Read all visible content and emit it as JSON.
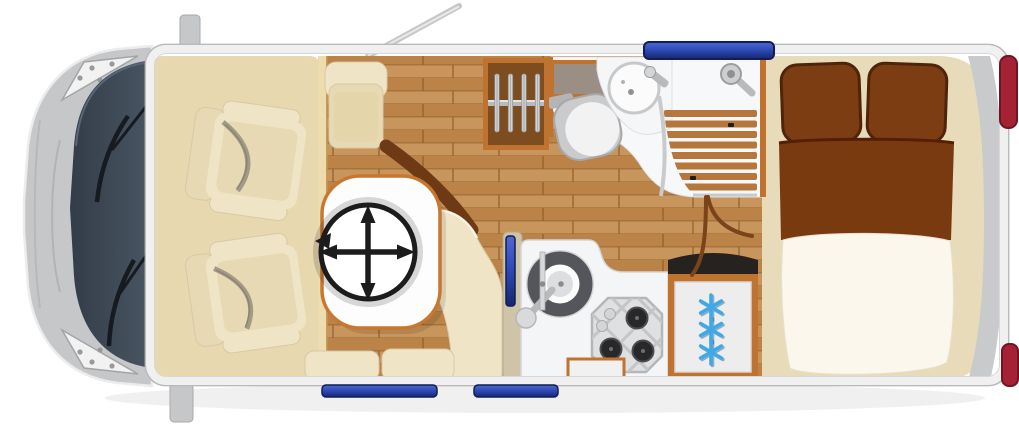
{
  "scene": {
    "kind": "motorhome-floorplan-top-view",
    "icons": {
      "table": "move-arrows-icon",
      "fridge": "snowflake-icon",
      "wardrobe": "hanger-icon",
      "vehicle": "antenna-icon"
    }
  },
  "counts": {
    "hangers": 4,
    "snowflakes": 3,
    "shower_slats": 8,
    "hob_burners": 3,
    "cab_seats": 2,
    "bench_cushions": 2,
    "pillows": 2,
    "bottom_windows": 2,
    "taillights": 2,
    "wipers": 2
  },
  "colors": {
    "body-gray": "#c6c7c9",
    "body-edge": "#ececed",
    "body-line": "#a8a9ab",
    "rim": "#f0f0f1",
    "rim-edge": "#b9babc",
    "windshield-a": "#333d49",
    "windshield-b": "#4a5563",
    "wiper": "#161b21",
    "mat": "#e7d8af",
    "wall-strip": "#ecdcae",
    "wood-a": "#c8955c",
    "wood-b": "#bb8347",
    "wood-seam": "#8f5f2b",
    "wall-orange": "#c0722f",
    "wardrobe-dark": "#7d4d20",
    "cream": "#efe5c6",
    "cream-dark": "#e6d9b3",
    "cream-line": "#d9c9a4",
    "cream-hi": "#f8f3e3",
    "pure-white": "#fdfdfe",
    "table-border": "#c8772f",
    "ink": "#1c1c1c",
    "counter": "#f4f5f7",
    "counter-line": "#d4d5d7",
    "steel": "#b9babc",
    "steel-dark": "#8f9193",
    "sink-ring": "#55565b",
    "hob-face": "#dfe0e2",
    "burner": "#28282a",
    "fridge-face": "#ededee",
    "fridge-top": "#262220",
    "snow": "#3fa9e8",
    "glass-blue": "#2e4cb8",
    "glass-dark": "#17266f",
    "glass-edge": "#101d56",
    "tail-red": "#a52134",
    "tail-dark": "#701522",
    "pillow": "#7d3d12",
    "blanket": "#7a3a10",
    "blanket-edge": "#531f05",
    "duvet": "#fbf7ed",
    "bath-white": "#f7f8f9",
    "slat": "#b5773c",
    "arc": "#6e3a16",
    "door-arc": "#7a441a",
    "bed-base": "#e7dbb9",
    "taupe": "#9b8e85",
    "pillar": "#cfc4a8",
    "bumper": "#c9cacc"
  }
}
